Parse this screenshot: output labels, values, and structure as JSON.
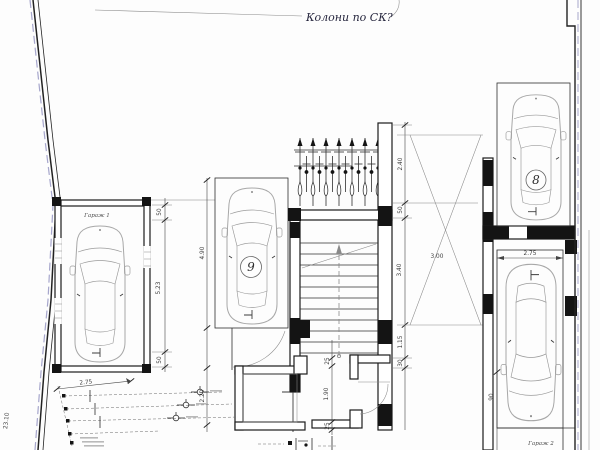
{
  "drawing": {
    "annotation": "Колони по СК?",
    "labels": {
      "garage1": "Гараж 1",
      "garage2": "Гараж 2",
      "spot_9": "9",
      "spot_8": "8"
    },
    "dimensions": {
      "left_top": "50",
      "left_main": "5.23",
      "left_bottom": "50",
      "middle_spot_length": "4.90",
      "middle_lower": "2.20",
      "plot_width": "2.75",
      "boundary_length": "23.10",
      "right_1": "2.40",
      "right_2": "50",
      "right_3": "3.40",
      "right_4": "1.15",
      "right_5": "30",
      "cross_width": "3.00",
      "room_top": "25",
      "room_main": "1.90",
      "room_bottom": "25",
      "spot2_width": "2.75",
      "spot2_side": "90"
    },
    "colors": {
      "ink": "#1c1c1c",
      "car_outline": "#a8a8a8",
      "dimension": "#444444",
      "boundary_accent": "#8888bb",
      "leader": "#9a9a9a"
    }
  }
}
